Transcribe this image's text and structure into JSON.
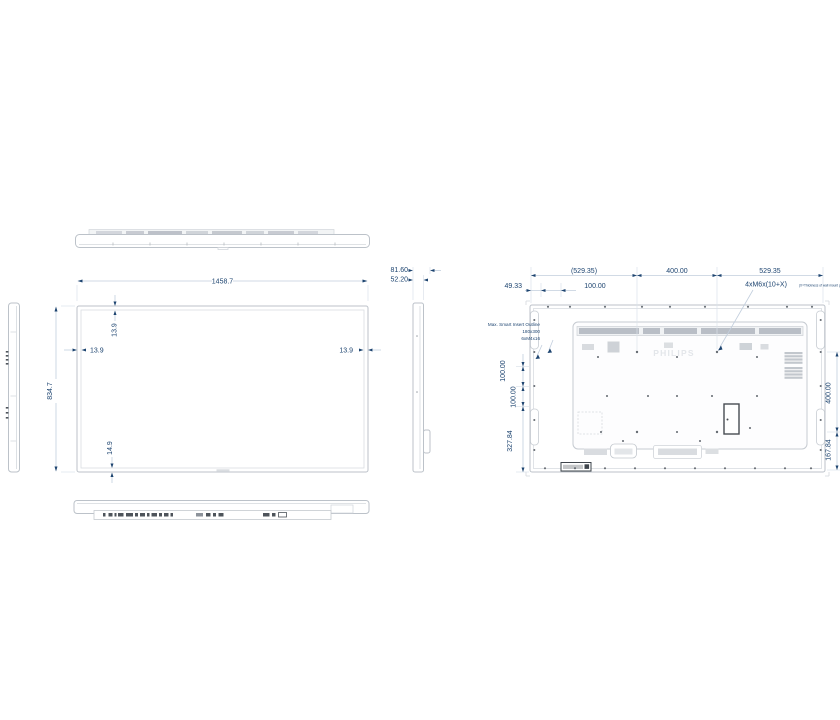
{
  "drawing": {
    "brand": "PHILIPS",
    "front": {
      "width": "1458.7",
      "height": "834.7",
      "bezel_top": "13.9",
      "bezel_left": "13.9",
      "bezel_right": "13.9",
      "bezel_bottom": "14.9"
    },
    "side": {
      "depth_total": "81.60",
      "depth_panel": "52.20"
    },
    "rear": {
      "offset_49": "49.33",
      "ref_529": "(529.35)",
      "offset_100": "100.00",
      "vesa_h": "400.00",
      "span_529": "529.35",
      "screw_spec": "4xM6x(10+X)",
      "screw_note": "(X=Thickness of wall mount plate)",
      "v_100a": "100.00",
      "v_100b": "100.00",
      "v_327": "327.84",
      "vesa_v": "400.00",
      "v_167": "167.84",
      "smart_insert_1": "Max. Smart Insert Outline",
      "smart_insert_2": "180x300",
      "smart_insert_3": "6xM4x16"
    }
  }
}
